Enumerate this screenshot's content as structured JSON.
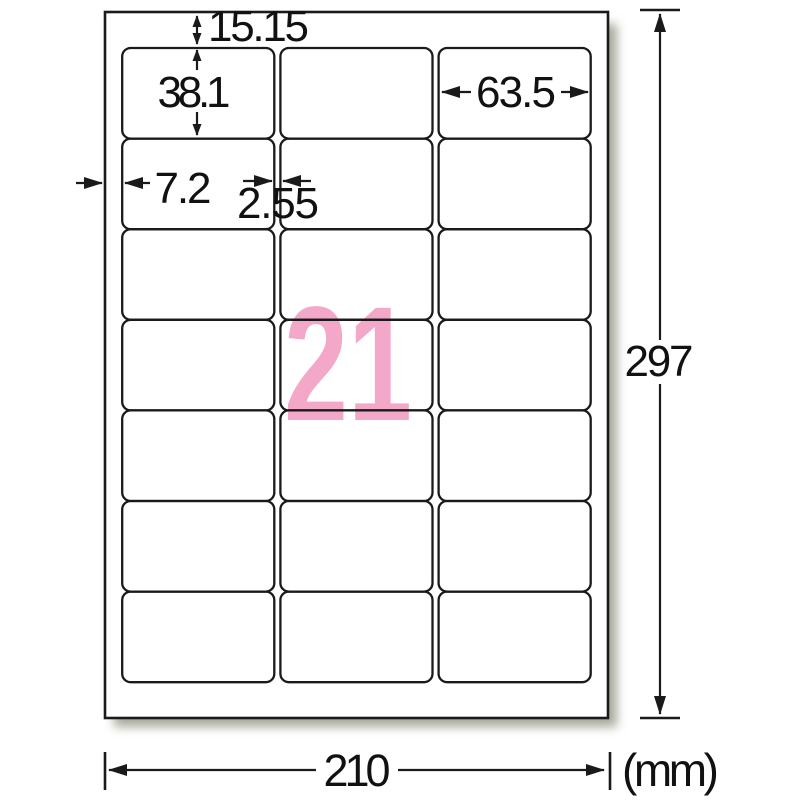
{
  "title": "A4 label sheet dimension diagram (21 labels)",
  "sheet": {
    "count_label": "21",
    "rows": 7,
    "cols": 3
  },
  "dimensions": {
    "top_margin_mm": "15.15",
    "label_height_mm": "38.1",
    "label_width_mm": "63.5",
    "left_margin_mm": "7.2",
    "column_gap_mm": "2.55",
    "sheet_height_mm": "297",
    "sheet_width_mm": "210",
    "unit": "(mm)"
  },
  "colors": {
    "accent_pink": "#F3A7C9",
    "line": "#1a1a1a",
    "shadow": "#A9A99C"
  }
}
